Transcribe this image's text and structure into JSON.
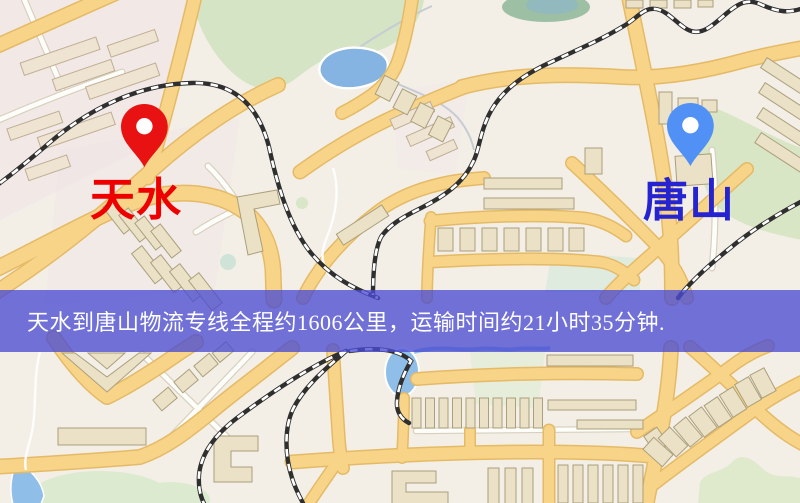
{
  "banner": {
    "text": "天水到唐山物流专线全程约1606公里，运输时间约21小时35分钟.",
    "overlay_color": "rgba(74,76,210,0.78)",
    "text_color": "#ffffff"
  },
  "markers": {
    "origin": {
      "label": "天水",
      "pin_color": "#e81212",
      "label_color": "#ee0000"
    },
    "destination": {
      "label": "唐山",
      "pin_color": "#5191f6",
      "label_color": "#2524d0"
    }
  },
  "map": {
    "colors": {
      "background": "#f3efe6",
      "road_major": "#f8d488",
      "road_minor": "#fdfdfa",
      "park": "#d5e4c4",
      "water": "#85b4e2",
      "building": "#eae1c6",
      "railway": "#2f2f2f"
    }
  }
}
